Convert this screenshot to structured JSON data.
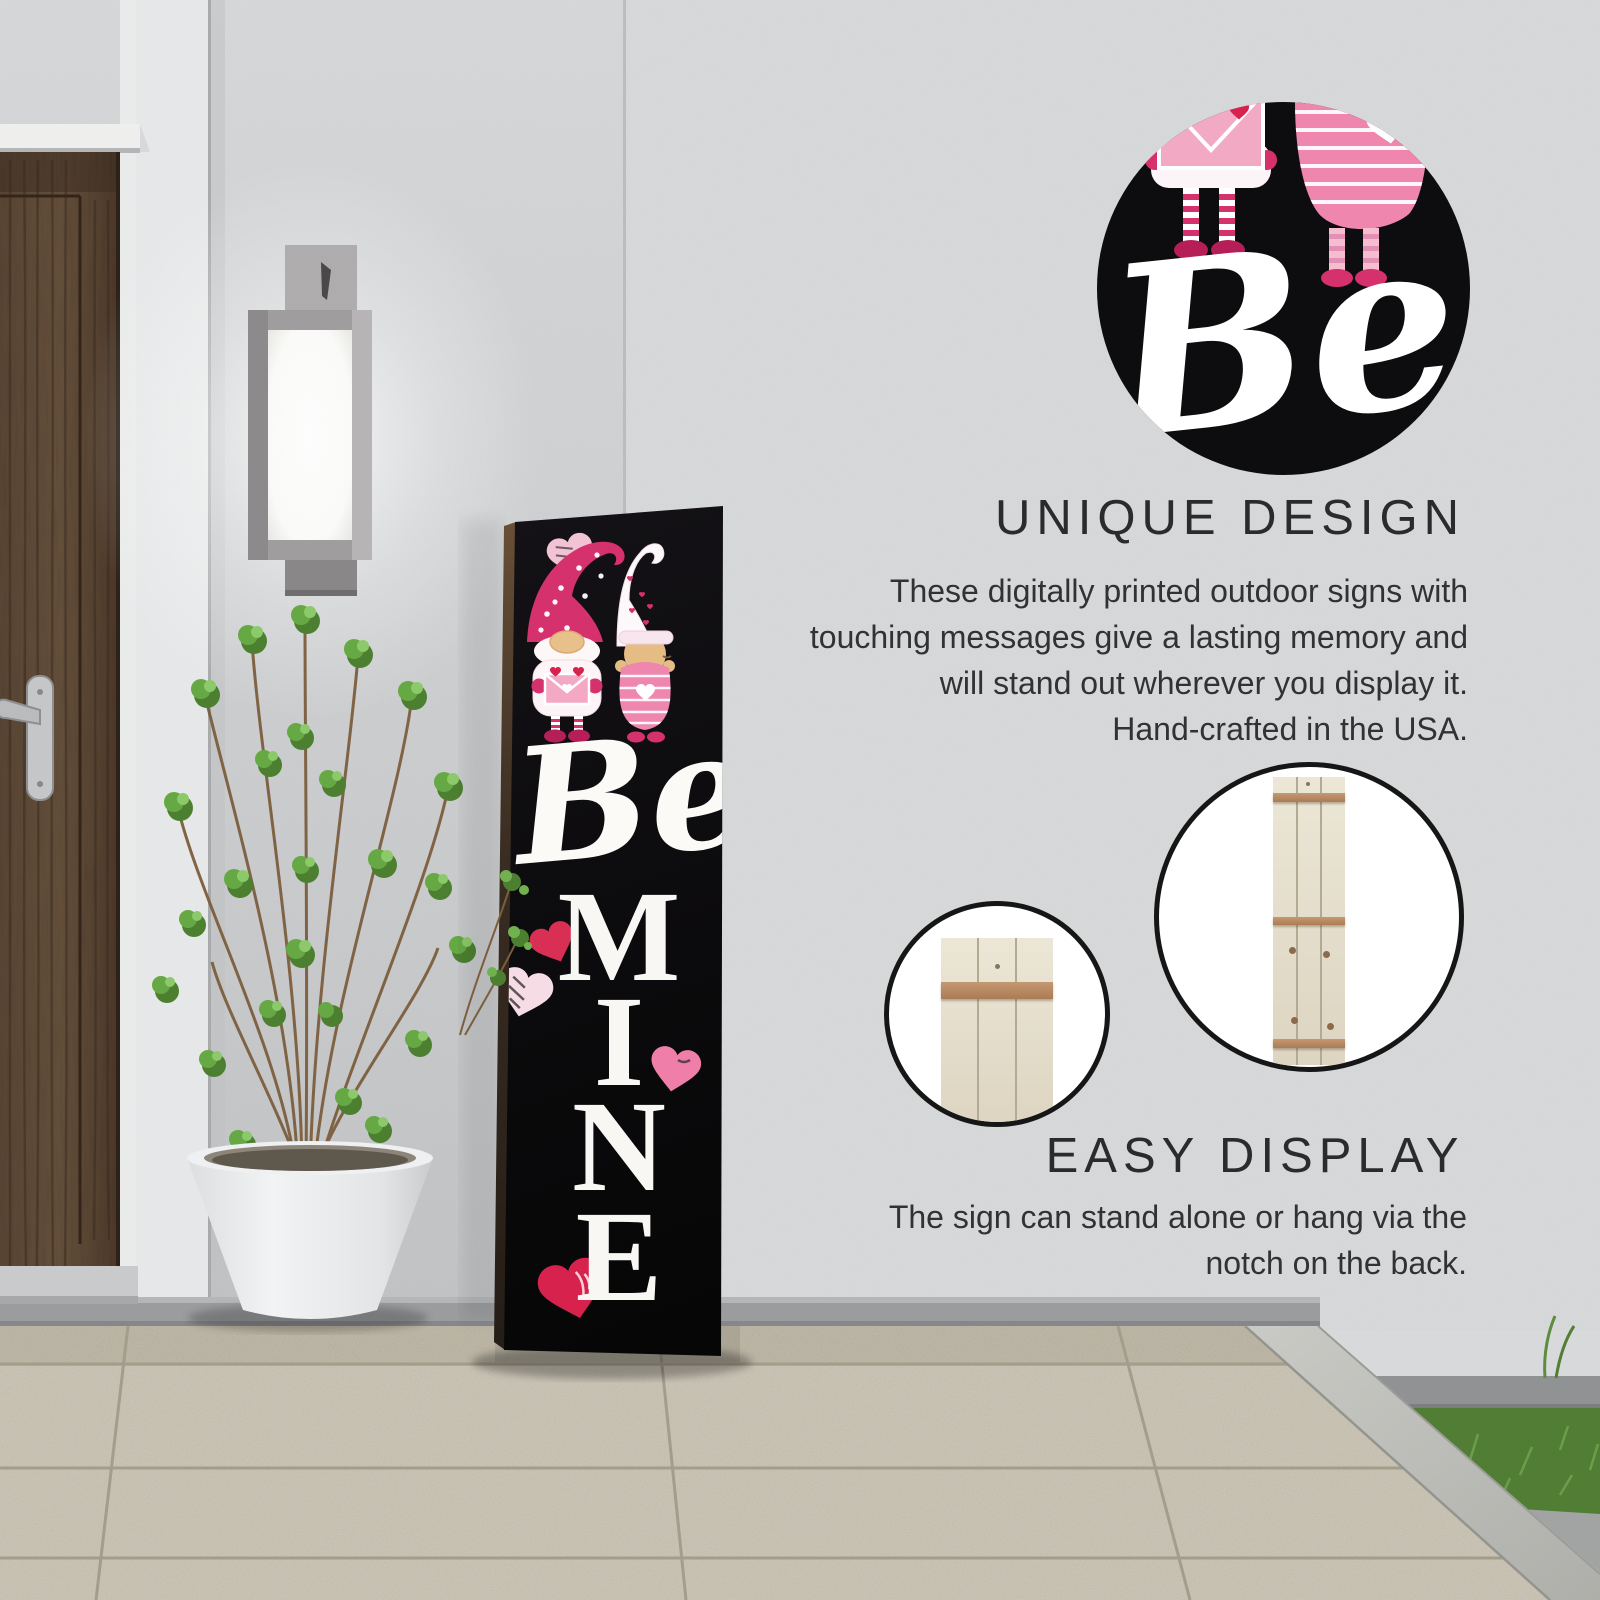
{
  "product_sign": {
    "script_word": "Be",
    "vertical_letters": [
      "M",
      "I",
      "N",
      "E"
    ],
    "message": "Be MINE"
  },
  "detail_circle": {
    "script_word": "Be"
  },
  "sections": [
    {
      "heading": "UNIQUE DESIGN",
      "lines": [
        "These digitally printed outdoor signs with",
        "touching messages give a lasting memory and",
        "will stand out wherever you display it.",
        "Hand-crafted in the USA."
      ]
    },
    {
      "heading": "EASY DISPLAY",
      "lines": [
        "The sign can stand alone or hang via the",
        "notch on the back."
      ]
    }
  ],
  "icons": {
    "heart": "heart-icon",
    "gnomes": "gnome-couple-illustration"
  },
  "colors": {
    "sign_background": "#0d0c0e",
    "accent_pink": "#d5316c",
    "heading_text": "#2b2b2d",
    "body_text": "#323234"
  }
}
